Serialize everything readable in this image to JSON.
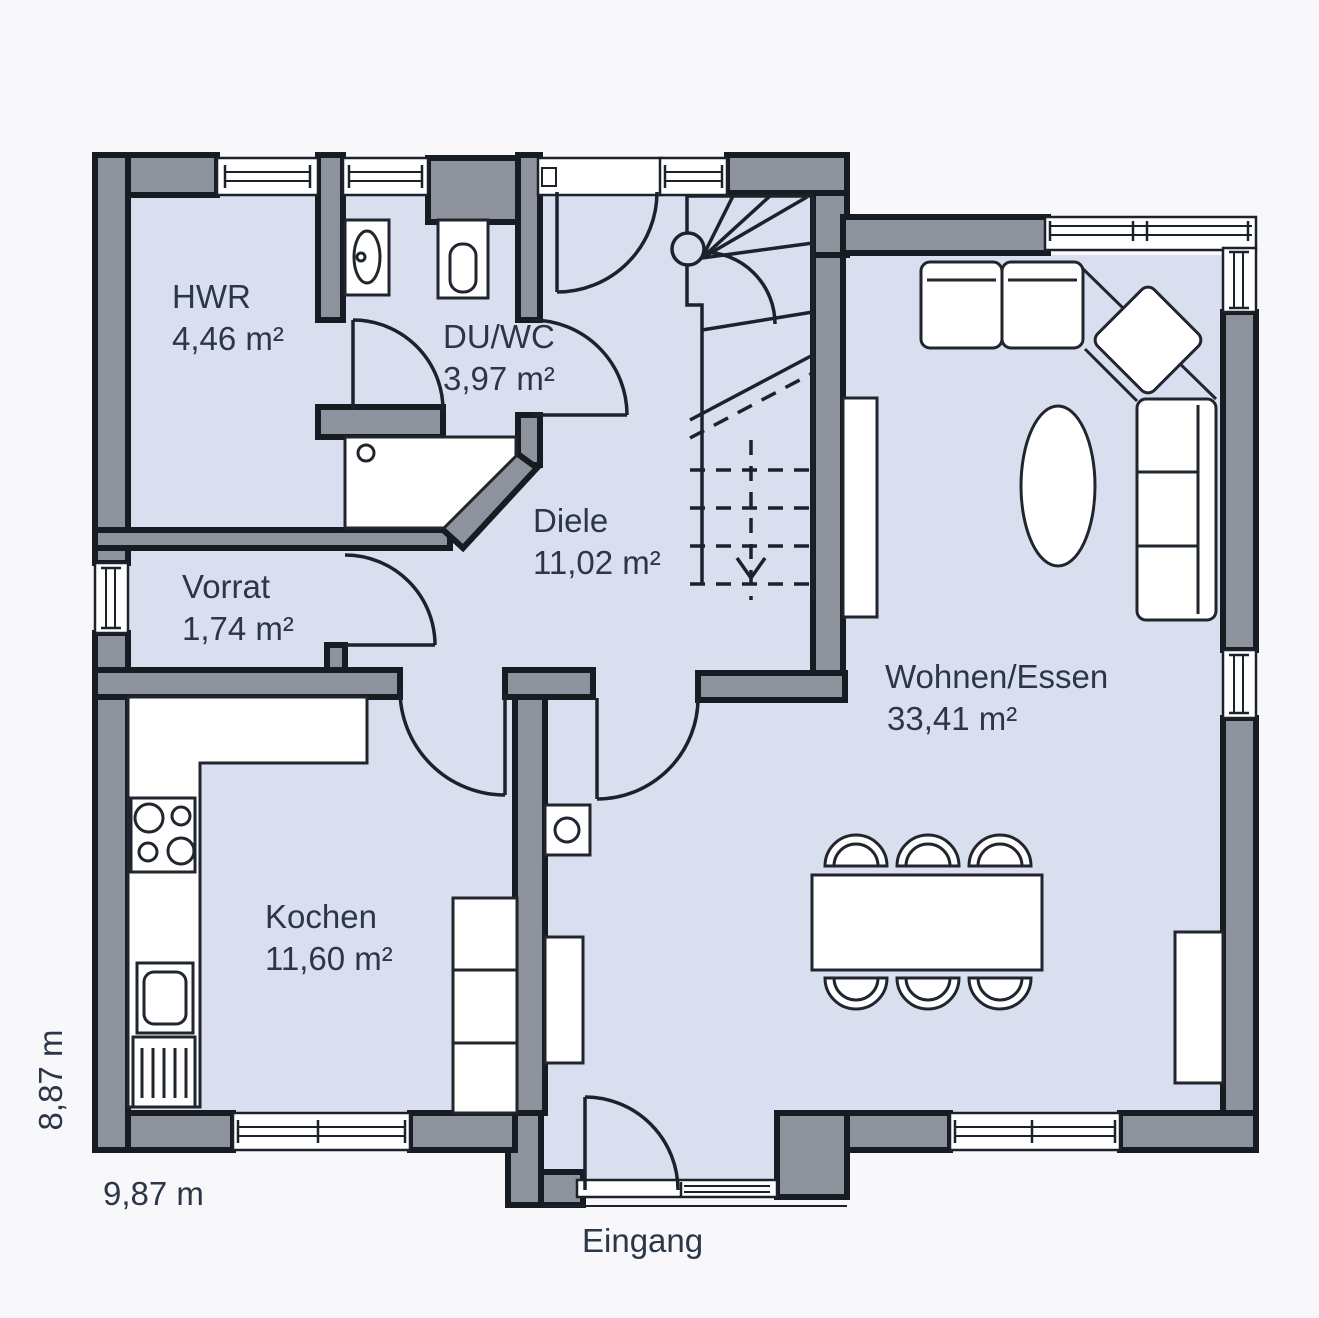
{
  "title": "Ground floor plan",
  "colors": {
    "outside": "#f8f8fb",
    "floor": "#dadfef",
    "wall_fill": "#8d929c",
    "wall_stroke": "#171b22",
    "thin_line": "#1c222b",
    "furniture_fill": "#ffffff",
    "text": "#2b3748"
  },
  "rooms": [
    {
      "id": "hwr",
      "name": "HWR",
      "area": "4,46 m²"
    },
    {
      "id": "du_wc",
      "name": "DU/WC",
      "area": "3,97 m²"
    },
    {
      "id": "diele",
      "name": "Diele",
      "area": "11,02 m²"
    },
    {
      "id": "vorrat",
      "name": "Vorrat",
      "area": "1,74 m²"
    },
    {
      "id": "kochen",
      "name": "Kochen",
      "area": "11,60 m²"
    },
    {
      "id": "wohnen",
      "name": "Wohnen/Essen",
      "area": "33,41 m²"
    }
  ],
  "annotations": {
    "entrance": "Eingang",
    "width_dim": "9,87 m",
    "height_dim": "8,87 m"
  }
}
